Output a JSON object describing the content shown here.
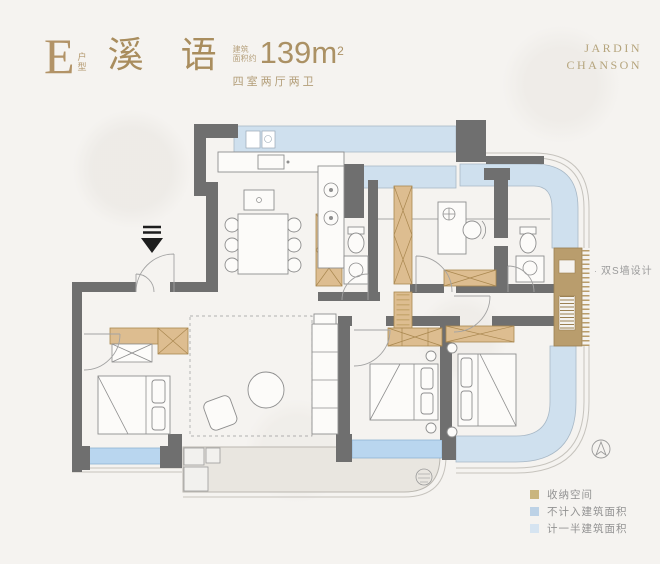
{
  "header": {
    "unit_code": "E",
    "unit_type_chars_1": "户",
    "unit_type_chars_2": "型",
    "project_name": "溪 语",
    "area_label_line1": "建筑",
    "area_label_line2": "面积约",
    "area_value": "139",
    "area_unit": "m",
    "area_exponent": "2",
    "layout_spec": "四室两厅两卫"
  },
  "brand": {
    "line1": "JARDIN",
    "line2": "CHANSON"
  },
  "plan": {
    "annotation_bullet": "·",
    "annotation_s_wall": "双S墙设计"
  },
  "legend": {
    "items": [
      {
        "label": "收纳空间",
        "color": "#c9b57e"
      },
      {
        "label": "不计入建筑面积",
        "color": "#bdd2e6"
      },
      {
        "label": "计一半建筑面积",
        "color": "#d6e4f1"
      }
    ]
  },
  "colors": {
    "background": "#f5f3f0",
    "wall": "#6f6f6f",
    "window_light": "#cfe0ee",
    "window_bright": "#b9d6ef",
    "cabinet": "#ddbd90",
    "s_wall": "#b99d6d",
    "terrace": "#e9e6e0",
    "title_gold": "#ab9164"
  }
}
